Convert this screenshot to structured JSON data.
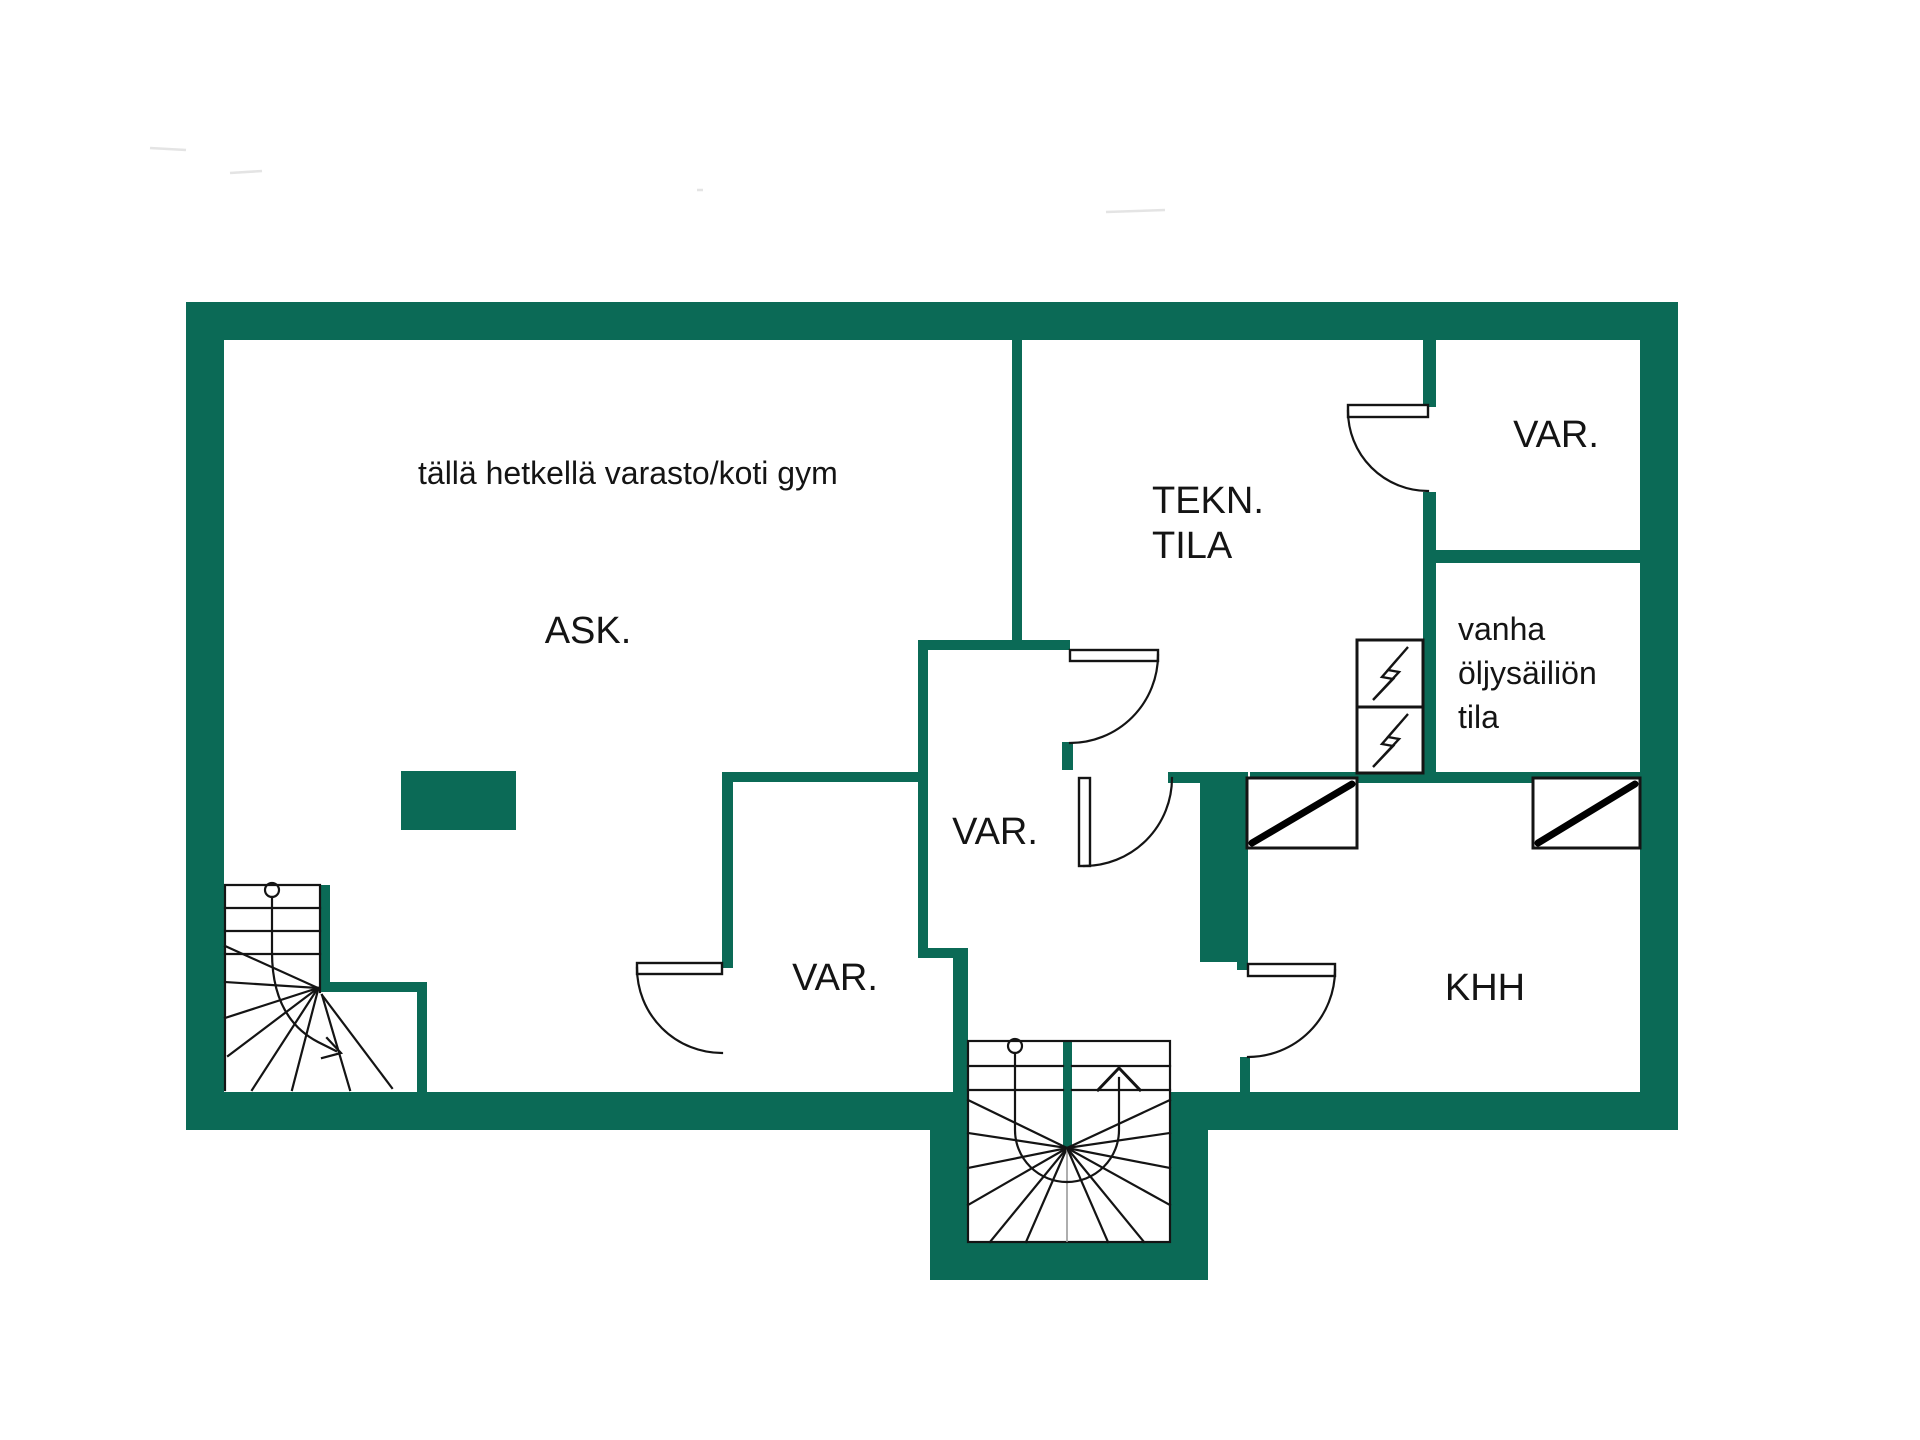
{
  "document": {
    "type": "basement floor plan",
    "language": "Finnish"
  },
  "colors": {
    "wall": "#0B6A56",
    "line": "#141414",
    "background": "#ffffff"
  },
  "rooms": {
    "ask": {
      "label": "ASK.",
      "note": "tällä hetkellä varasto/koti gym"
    },
    "tekn": {
      "label_line1": "TEKN.",
      "label_line2": "TILA"
    },
    "var_top_right": {
      "label": "VAR."
    },
    "var_closet": {
      "label": "VAR."
    },
    "var_lower": {
      "label": "VAR."
    },
    "oil_room": {
      "label_line1": "vanha",
      "label_line2": "öljysäiliön",
      "label_line3": "tila"
    },
    "khh": {
      "label": "KHH"
    }
  },
  "icons": {
    "electrical_panel": "lightning-bolt-icon",
    "hatch_window": "diagonal-hatch-icon",
    "stair_direction": "arrow-up-icon",
    "walk_line_start": "circle-marker-icon"
  }
}
